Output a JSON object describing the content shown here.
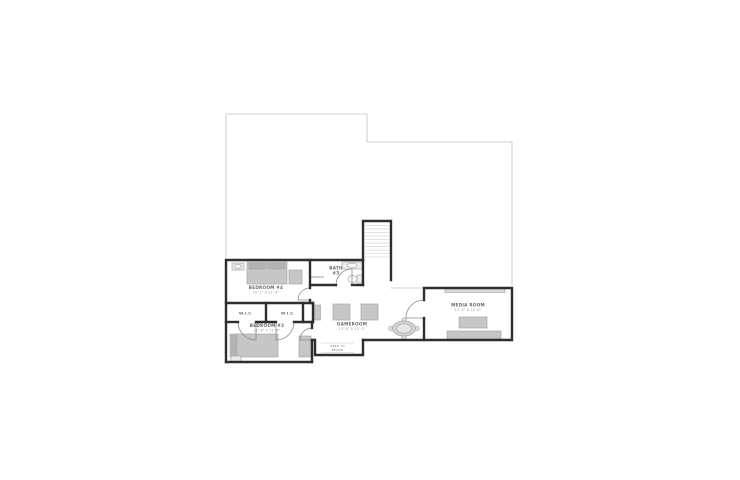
{
  "floorplan": {
    "type": "second-floor-plan",
    "rooms": {
      "bedroom4": {
        "name": "BEDROOM #4",
        "dims": "10'-2\" X 11'-4\""
      },
      "bath3": {
        "name": "BATH",
        "number": "#3"
      },
      "wic_left": {
        "name": "W.I.C."
      },
      "wic_right": {
        "name": "W.I.C."
      },
      "bedroom3": {
        "name": "BEDROOM #3",
        "dims": "11'-4\" X 11'-6\""
      },
      "gameroom": {
        "name": "GAMEROOM",
        "dims": "13'-0\" X 13'-1\""
      },
      "media": {
        "name": "MEDIA ROOM",
        "dims": "17'-4\" X 12'-0\""
      },
      "open_below": {
        "line1": "OPEN TO",
        "line2": "BELOW"
      }
    },
    "features": [
      "stairs",
      "floor-below-outline"
    ],
    "colors": {
      "wall": "#2e2e2e",
      "outline_below": "#d9d9d9",
      "treads": "#e3e3e3",
      "furniture": "#c6c6c6",
      "furniture_light": "#e9e9e9",
      "door": "#8a8a8a",
      "text": "#6a6a6a",
      "background": "#ffffff"
    }
  }
}
